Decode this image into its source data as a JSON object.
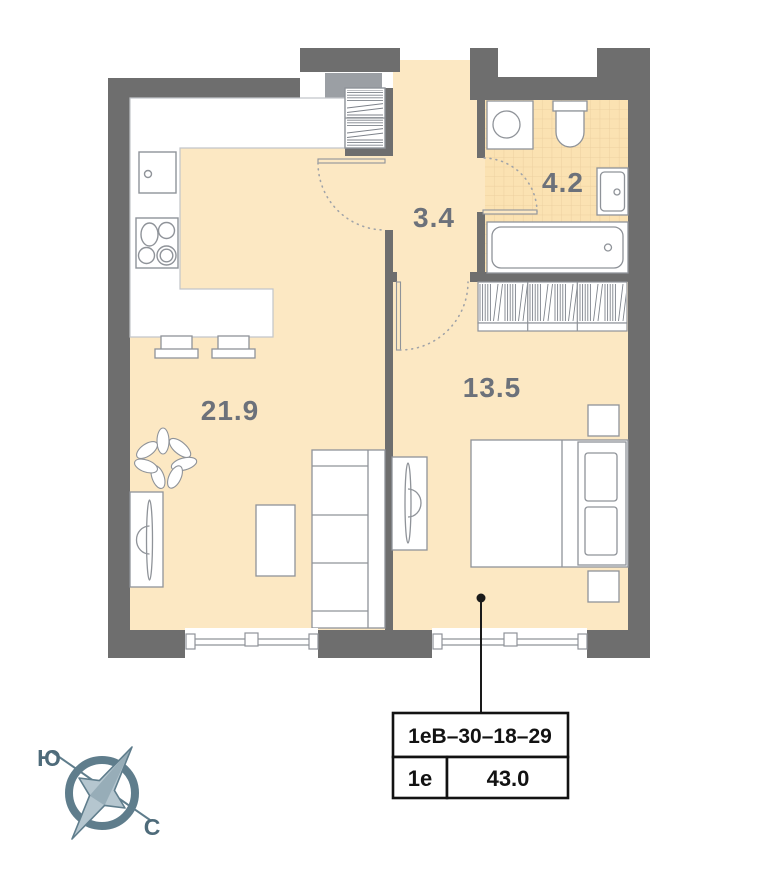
{
  "plan": {
    "rooms": [
      {
        "name": "living-kitchen",
        "area_label": "21.9"
      },
      {
        "name": "hallway",
        "area_label": "3.4"
      },
      {
        "name": "bathroom",
        "area_label": "4.2"
      },
      {
        "name": "bedroom",
        "area_label": "13.5"
      }
    ],
    "colors": {
      "wall": "#6e6e6e",
      "wall_light": "#9b9fa4",
      "floor": "#fce8c3",
      "bathroom_tile": "#fbe2b2",
      "tile_grid": "#ecd0a0",
      "furniture_outline": "#8f9399",
      "label_text": "#6c717a"
    }
  },
  "compass": {
    "south_label": "Ю",
    "north_label": "С",
    "ring_color": "#5f7d8c",
    "needle_fill": "#b5c6cf"
  },
  "unit_card": {
    "code": "1еВ–30–18–29",
    "type": "1е",
    "area": "43.0"
  }
}
